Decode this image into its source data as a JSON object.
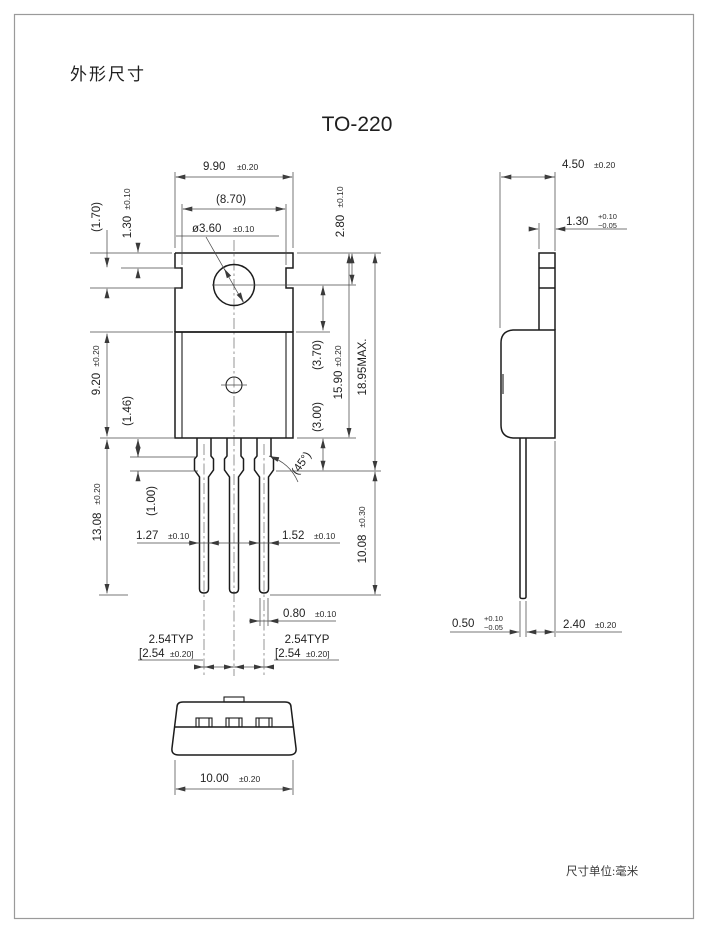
{
  "page": {
    "title": "外形尺寸",
    "package_name": "TO-220",
    "unit_note": "尺寸单位:毫米"
  },
  "colors": {
    "ink": "#1c1c1c",
    "dim_line": "#4a4a4a",
    "border": "#9a9a9a",
    "background": "#ffffff"
  },
  "front_view": {
    "overall_width": {
      "value": "9.90",
      "tol": "±0.20"
    },
    "body_width": "(8.70)",
    "hole_diameter": {
      "value": "ø3.60",
      "tol": "±0.10"
    },
    "tab_top_to_hole_center": {
      "value": "2.80",
      "tol": "±0.10"
    },
    "side_notch_height": "(1.70)",
    "tab_step_height": {
      "value": "1.30",
      "tol": "±0.10"
    },
    "body_height": {
      "value": "9.20",
      "tol": "±0.20"
    },
    "lead_root_length": "(1.46)",
    "lead_length": {
      "value": "13.08",
      "tol": "±0.20"
    },
    "lead_shoulder_length": "(1.00)",
    "hole_center_to_body_top": "(3.70)",
    "body_bottom_to_shoulder": "(3.00)",
    "tab_top_to_body_bottom": {
      "value": "15.90",
      "tol": "±0.20"
    },
    "overall_height_max": "18.95MAX.",
    "shoulder_to_lead_tip": {
      "value": "10.08",
      "tol": "±0.30"
    },
    "shoulder_chamfer": "(45°)",
    "lead_width_left": {
      "value": "1.27",
      "tol": "±0.10"
    },
    "lead_width_right": {
      "value": "1.52",
      "tol": "±0.10"
    },
    "lead_tip_width": {
      "value": "0.80",
      "tol": "±0.10"
    },
    "pitch_left": {
      "typ": "2.54TYP",
      "bracket_value": "[2.54",
      "bracket_tol": "±0.20]"
    },
    "pitch_right": {
      "typ": "2.54TYP",
      "bracket_value": "[2.54",
      "bracket_tol": "±0.20]"
    }
  },
  "side_view": {
    "body_width": {
      "value": "4.50",
      "tol": "±0.20"
    },
    "tab_thickness": {
      "value": "1.30",
      "tol_plus": "+0.10",
      "tol_minus": "−0.05"
    },
    "lead_thickness": {
      "value": "0.50",
      "tol_plus": "+0.10",
      "tol_minus": "−0.05"
    },
    "body_thickness": {
      "value": "2.40",
      "tol": "±0.20"
    }
  },
  "bottom_view": {
    "body_width": {
      "value": "10.00",
      "tol": "±0.20"
    }
  }
}
